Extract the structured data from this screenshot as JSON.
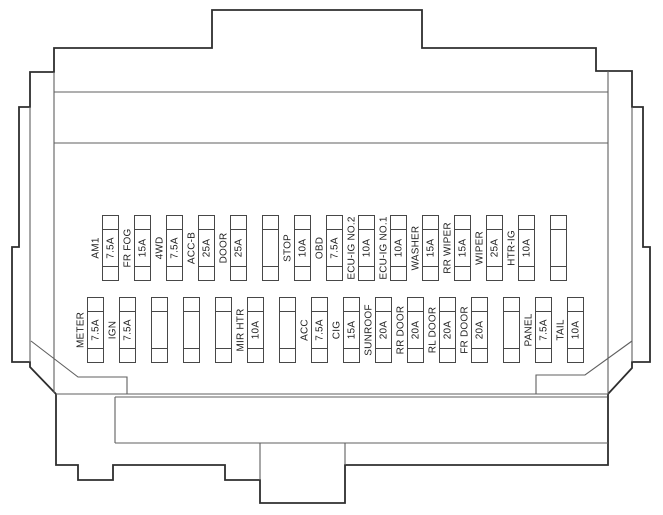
{
  "fuse_box": {
    "rows": [
      {
        "id": "upper-row",
        "fuses": [
          {
            "label": "AM1",
            "amp": "7.5A"
          },
          {
            "label": "FR FOG",
            "amp": "15A"
          },
          {
            "label": "4WD",
            "amp": "7.5A"
          },
          {
            "label": "ACC-B",
            "amp": "25A"
          },
          {
            "label": "DOOR",
            "amp": "25A"
          },
          {
            "label": "",
            "amp": ""
          },
          {
            "label": "STOP",
            "amp": "10A"
          },
          {
            "label": "OBD",
            "amp": "7.5A"
          },
          {
            "label": "ECU-IG NO.2",
            "amp": "10A"
          },
          {
            "label": "ECU-IG NO.1",
            "amp": "10A"
          },
          {
            "label": "WASHER",
            "amp": "15A"
          },
          {
            "label": "RR WIPER",
            "amp": "15A"
          },
          {
            "label": "WIPER",
            "amp": "25A"
          },
          {
            "label": "HTR-IG",
            "amp": "10A"
          },
          {
            "label": "",
            "amp": ""
          }
        ]
      },
      {
        "id": "lower-row",
        "fuses": [
          {
            "label": "METER",
            "amp": "7.5A"
          },
          {
            "label": "IGN",
            "amp": "7.5A"
          },
          {
            "label": "",
            "amp": ""
          },
          {
            "label": "",
            "amp": ""
          },
          {
            "label": "",
            "amp": ""
          },
          {
            "label": "MIR HTR",
            "amp": "10A"
          },
          {
            "label": "",
            "amp": ""
          },
          {
            "label": "ACC",
            "amp": "7.5A"
          },
          {
            "label": "CIG",
            "amp": "15A"
          },
          {
            "label": "SUNROOF",
            "amp": "20A"
          },
          {
            "label": "RR DOOR",
            "amp": "20A"
          },
          {
            "label": "RL DOOR",
            "amp": "20A"
          },
          {
            "label": "FR DOOR",
            "amp": "20A"
          },
          {
            "label": "",
            "amp": ""
          },
          {
            "label": "PANEL",
            "amp": "7.5A"
          },
          {
            "label": "TAIL",
            "amp": "10A"
          }
        ]
      }
    ]
  },
  "colors": {
    "outline": "#2e2e2e",
    "inner_line": "#5f5f5f",
    "fuse_line": "#474747",
    "text": "#1e1e1e",
    "background": "#ffffff"
  }
}
